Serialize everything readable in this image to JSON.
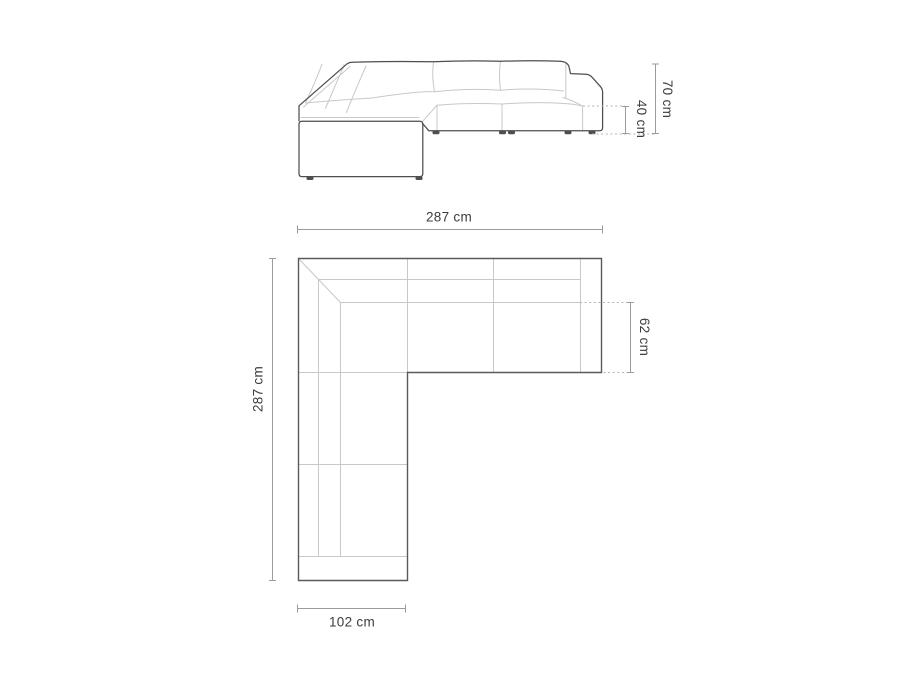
{
  "diagram": {
    "subject": "corner-sofa-dimension-drawing",
    "views": {
      "front_elevation": {
        "dimensions": {
          "total_height": {
            "label": "70 cm"
          },
          "seat_height": {
            "label": "40 cm"
          }
        }
      },
      "top_plan": {
        "dimensions": {
          "total_width": {
            "label": "287 cm"
          },
          "total_depth": {
            "label": "287 cm"
          },
          "seat_depth": {
            "label": "62 cm"
          },
          "chaise_width": {
            "label": "102 cm"
          }
        }
      }
    },
    "colors": {
      "background": "#ffffff",
      "outline": "#4f4f4f",
      "plan_outline": "#5a5a5a",
      "detail_line": "#c8c8c8",
      "dimension_line": "#9b9b9b",
      "leader_dotted": "#b3b3b3",
      "label_text": "#3c3c3c"
    }
  }
}
